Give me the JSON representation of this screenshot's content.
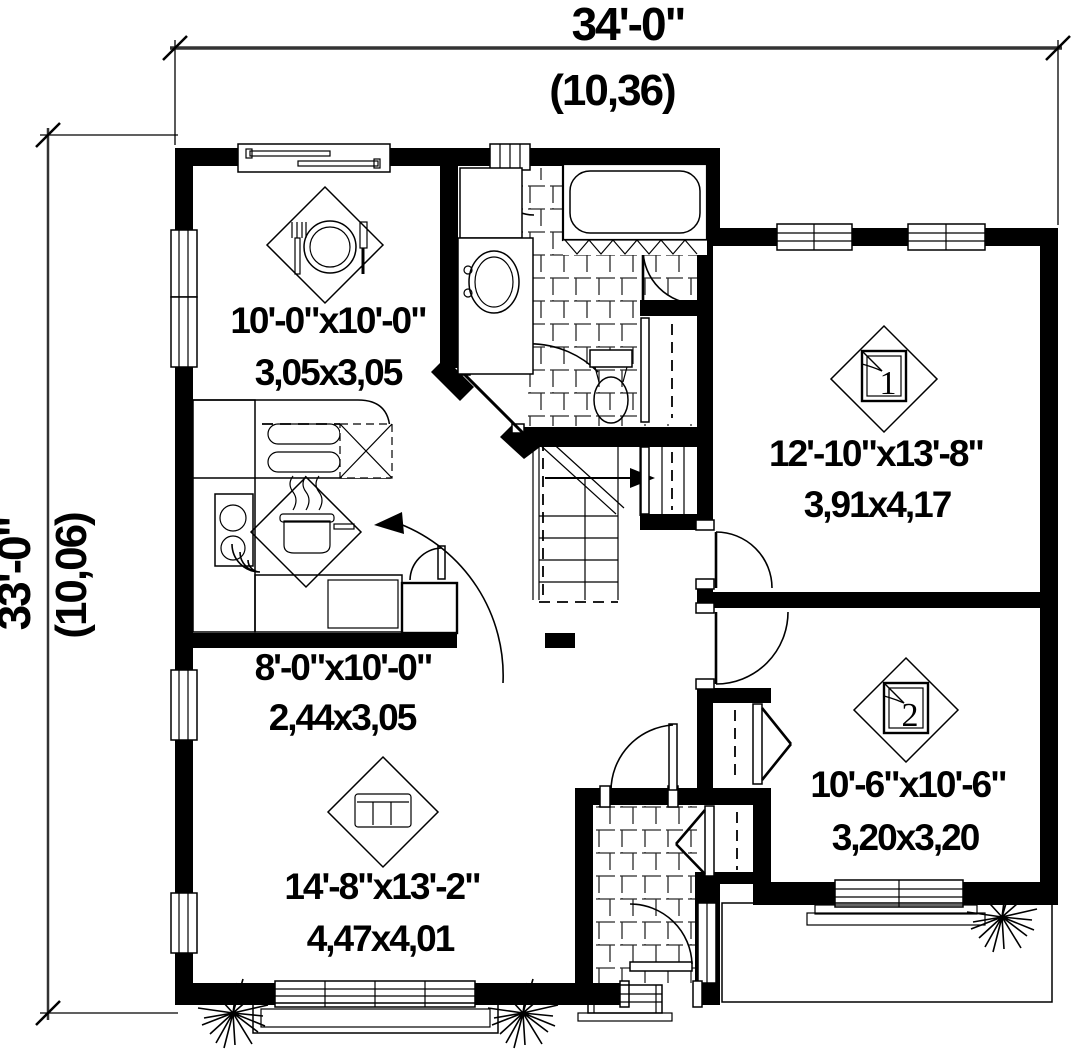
{
  "dimensions": {
    "top": {
      "imperial": "34'-0\"",
      "metric": "(10,36)"
    },
    "left": {
      "imperial": "33'-0\"",
      "metric": "(10,06)"
    }
  },
  "rooms": {
    "dining": {
      "imperial": "10'-0\"x10'-0\"",
      "metric": "3,05x3,05"
    },
    "kitchen": {
      "imperial": "8'-0\"x10'-0\"",
      "metric": "2,44x3,05"
    },
    "living": {
      "imperial": "14'-8\"x13'-2\"",
      "metric": "4,47x4,01"
    },
    "bedroom1": {
      "number": "1",
      "imperial": "12'-10\"x13'-8\"",
      "metric": "3,91x4,17"
    },
    "bedroom2": {
      "number": "2",
      "imperial": "10'-6\"x10'-6\"",
      "metric": "3,20x3,20"
    }
  },
  "colors": {
    "wall": "#000000",
    "background": "#ffffff",
    "line": "#1a1a1a"
  }
}
